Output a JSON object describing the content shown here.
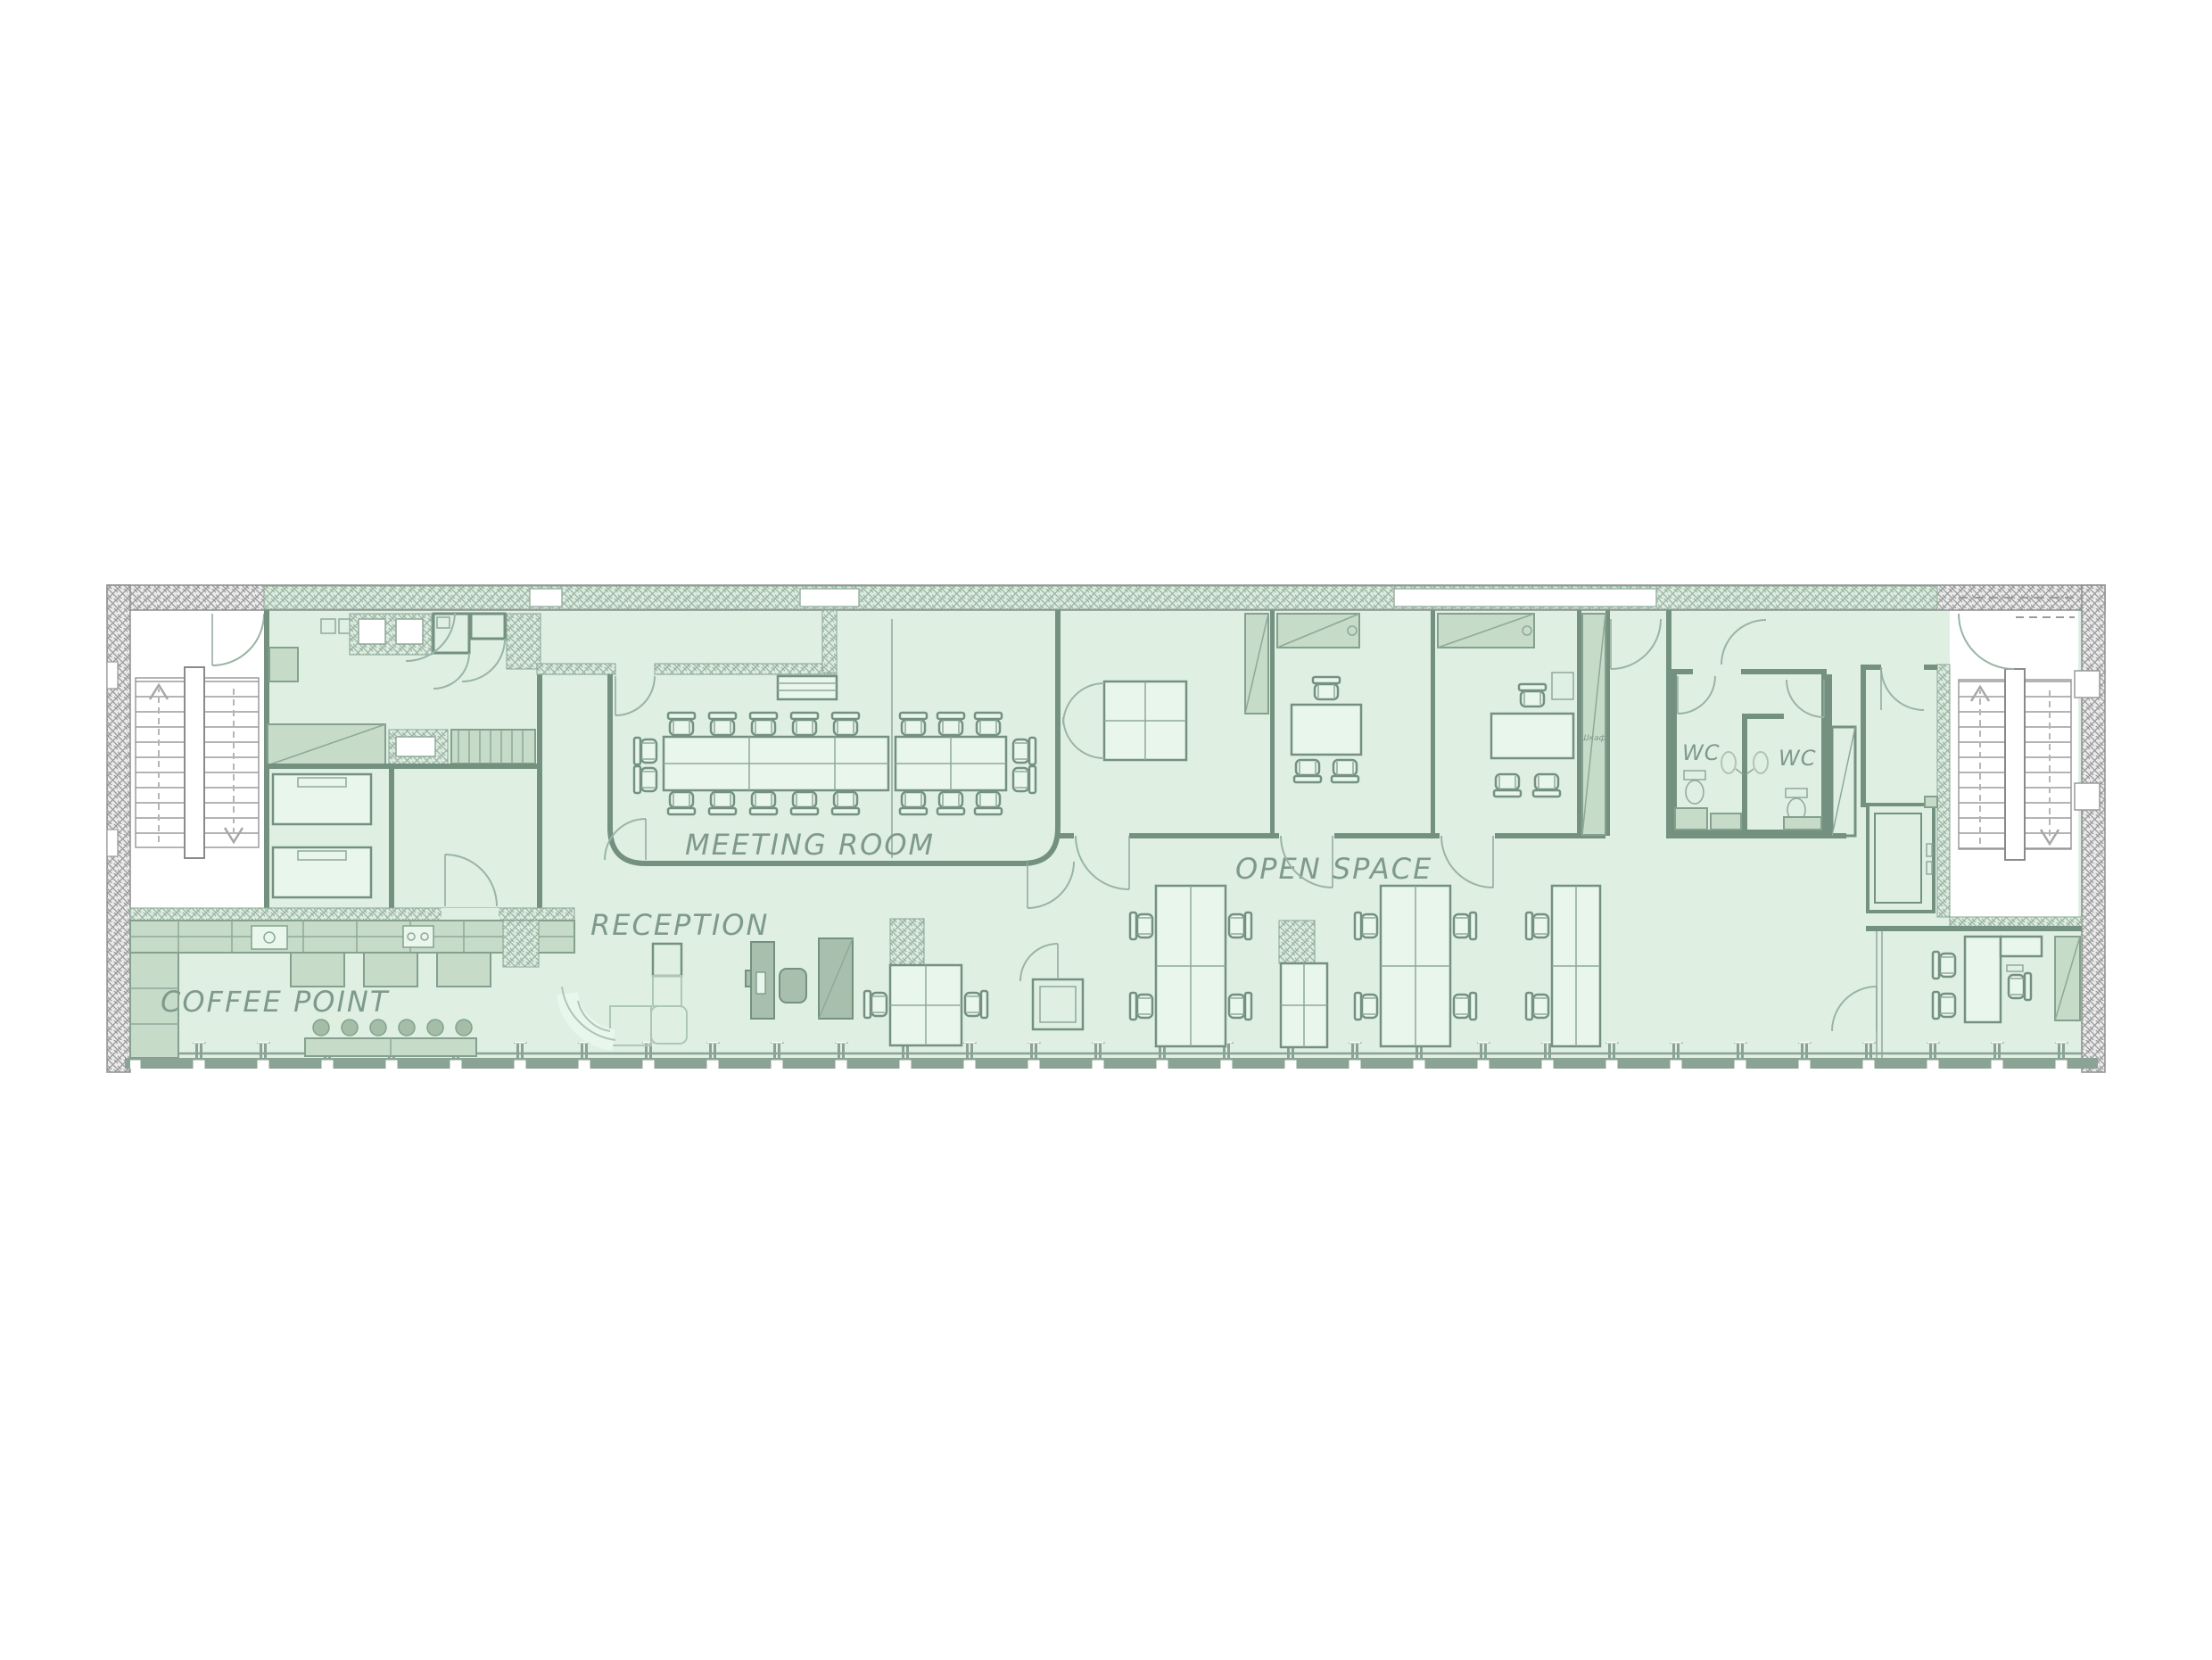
{
  "plan": {
    "rooms": {
      "meeting_room": "MEETING ROOM",
      "open_space": "OPEN SPACE",
      "reception": "RECEPTION",
      "coffee_point": "COFFEE POINT",
      "wc_1": "WC",
      "wc_2": "WC",
      "cabinet_label": "Шкаф"
    },
    "colors": {
      "floor_tint": "#dff0e3",
      "furniture_light": "#e9f6ec",
      "furniture_mid": "#c6dbc8",
      "furniture_dark": "#a9bfae",
      "wall_line": "#74917f",
      "hatch_gray": "#9a9a9a",
      "hatch_green": "#9cb5a3",
      "window_band": "#8ba394",
      "label_text": "#7f9a8c"
    }
  }
}
